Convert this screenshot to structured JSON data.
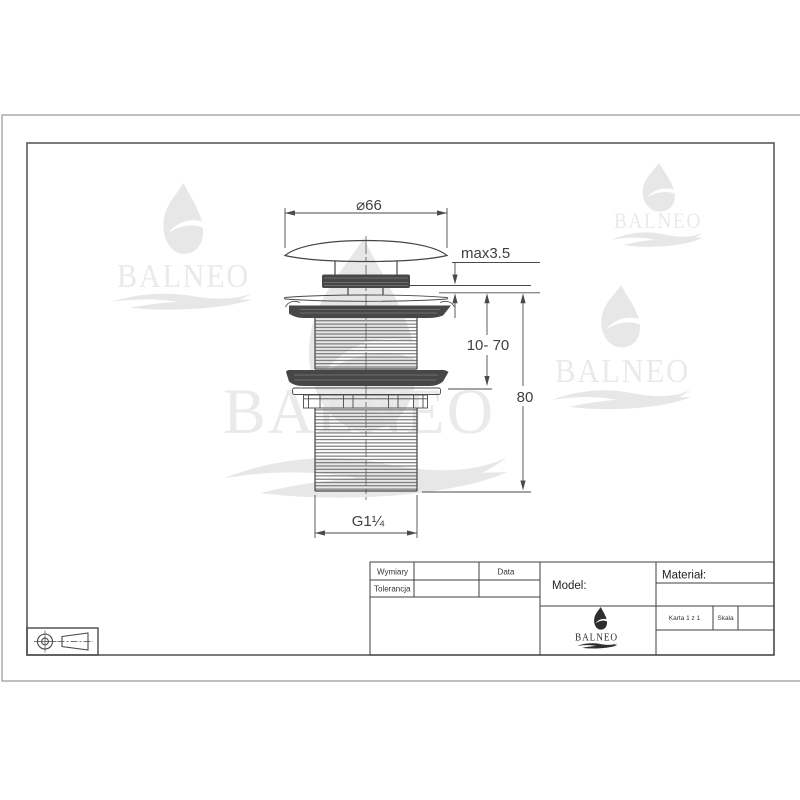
{
  "sheet": {
    "brand": "BALNEO",
    "dims": {
      "diameter": "⌀66",
      "max_height": "max3.5",
      "range": "10- 70",
      "total": "80",
      "thread": "G1¼"
    },
    "title_block": {
      "row1_label": "Wymiary",
      "row2_label": "Tolerancja",
      "date_label": "Data",
      "model_label": "Model:",
      "material_label": "Materiał:",
      "sheet_label": "Karta 1 z 1",
      "scale_label": "Skala"
    },
    "colors": {
      "line": "#454545",
      "dark_fill": "#474747",
      "watermark": "#e7e7e7",
      "frame_outer": "#979797",
      "frame_inner": "#5a5a5a"
    }
  }
}
